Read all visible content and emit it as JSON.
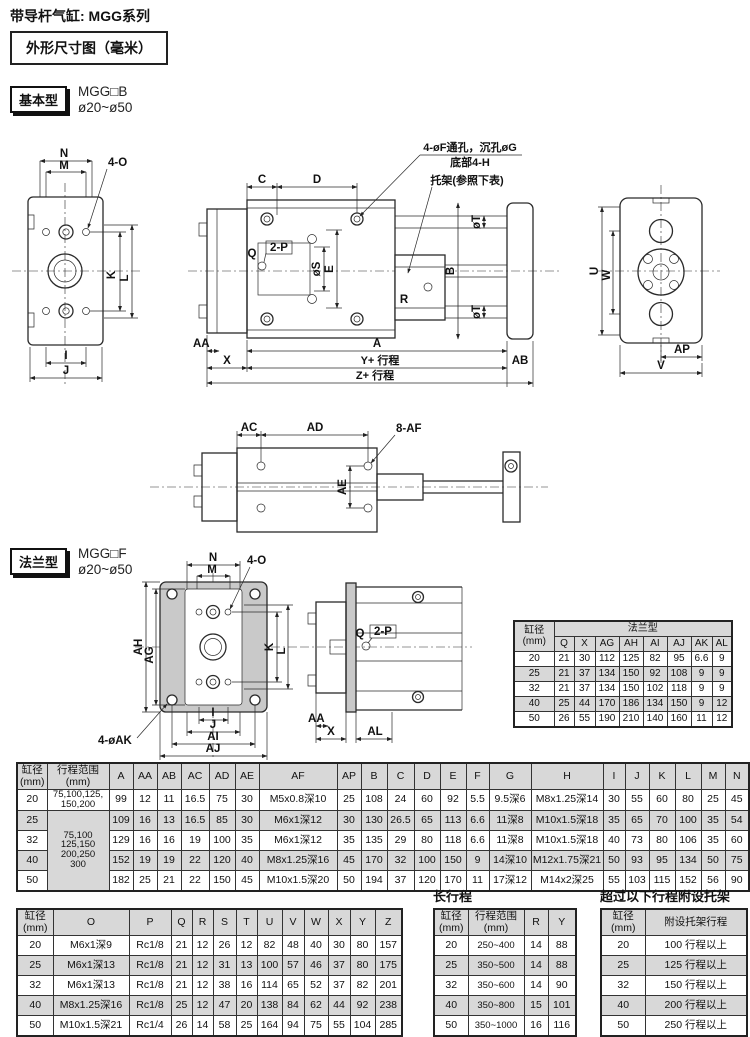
{
  "page": {
    "title": "带导杆气缸: MGG系列",
    "dimBoxTitle": "外形尺寸图（毫米）"
  },
  "colors": {
    "tableShade": "#d8d8d8",
    "flangePlate": "#c9c9c9",
    "line": "#2a2a2a"
  },
  "basic": {
    "badge": "基本型",
    "model": "MGG□B",
    "bore": "ø20~ø50"
  },
  "flange": {
    "badge": "法兰型",
    "model": "MGG□F",
    "bore": "ø20~ø50"
  },
  "labels": {
    "n": "N",
    "m": "M",
    "k": "K",
    "l": "L",
    "i": "I",
    "j": "J",
    "c": "C",
    "d": "D",
    "q": "Q",
    "e": "E",
    "b": "B",
    "r": "R",
    "a": "A",
    "x": "X",
    "u": "U",
    "w": "W",
    "v": "V",
    "aa": "AA",
    "ab": "AB",
    "ac": "AC",
    "ad": "AD",
    "ae": "AE",
    "ap": "AP",
    "ag": "AG",
    "ah": "AH",
    "ai": "AI",
    "aj": "AJ",
    "al": "AL",
    "fourO": "4-O",
    "twoP": "2-P",
    "phiS": "øS",
    "phiT": "øT",
    "eightAF": "8-AF",
    "fourAK": "4-øAK",
    "yStroke": "Y+ 行程",
    "zStroke": "Z+ 行程",
    "holeNote1": "4-øF通孔，沉孔øG",
    "holeNote2": "底部4-H",
    "bracketNote": "托架(参照下表)"
  },
  "flangeTable": {
    "boreHeader": "缸径\n(mm)",
    "groupHeader": "法兰型",
    "columns": [
      "Q",
      "X",
      "AG",
      "AH",
      "AI",
      "AJ",
      "AK",
      "AL"
    ],
    "rows": [
      [
        "20",
        "21",
        "30",
        "112",
        "125",
        "82",
        "95",
        "6.6",
        "9"
      ],
      [
        "25",
        "21",
        "37",
        "134",
        "150",
        "92",
        "108",
        "9",
        "9"
      ],
      [
        "32",
        "21",
        "37",
        "134",
        "150",
        "102",
        "118",
        "9",
        "9"
      ],
      [
        "40",
        "25",
        "44",
        "170",
        "186",
        "134",
        "150",
        "9",
        "12"
      ],
      [
        "50",
        "26",
        "55",
        "190",
        "210",
        "140",
        "160",
        "11",
        "12"
      ]
    ]
  },
  "mainTable": {
    "boreHeader": "缸径\n(mm)",
    "strokeHeader": "行程范围\n(mm)",
    "row20Stroke": "75,100,125,\n150,200",
    "mergedStroke": "75,100\n125,150\n200,250\n300",
    "columns": [
      "A",
      "AA",
      "AB",
      "AC",
      "AD",
      "AE",
      "AF",
      "AP",
      "B",
      "C",
      "D",
      "E",
      "F",
      "G",
      "H",
      "I",
      "J",
      "K",
      "L",
      "M",
      "N"
    ],
    "rows": [
      [
        "20",
        "99",
        "12",
        "11",
        "16.5",
        "75",
        "30",
        "M5x0.8深10",
        "25",
        "108",
        "24",
        "60",
        "92",
        "5.5",
        "9.5深6",
        "M8x1.25深14",
        "30",
        "55",
        "60",
        "80",
        "25",
        "45"
      ],
      [
        "25",
        "109",
        "16",
        "13",
        "16.5",
        "85",
        "30",
        "M6x1深12",
        "30",
        "130",
        "26.5",
        "65",
        "113",
        "6.6",
        "11深8",
        "M10x1.5深18",
        "35",
        "65",
        "70",
        "100",
        "35",
        "54"
      ],
      [
        "32",
        "129",
        "16",
        "16",
        "19",
        "100",
        "35",
        "M6x1深12",
        "35",
        "135",
        "29",
        "80",
        "118",
        "6.6",
        "11深8",
        "M10x1.5深18",
        "40",
        "73",
        "80",
        "106",
        "35",
        "60"
      ],
      [
        "40",
        "152",
        "19",
        "19",
        "22",
        "120",
        "40",
        "M8x1.25深16",
        "45",
        "170",
        "32",
        "100",
        "150",
        "9",
        "14深10",
        "M12x1.75深21",
        "50",
        "93",
        "95",
        "134",
        "50",
        "75"
      ],
      [
        "50",
        "182",
        "25",
        "21",
        "22",
        "150",
        "45",
        "M10x1.5深20",
        "50",
        "194",
        "37",
        "120",
        "170",
        "11",
        "17深12",
        "M14x2深25",
        "55",
        "103",
        "115",
        "152",
        "56",
        "90"
      ]
    ]
  },
  "lowerTable": {
    "boreHeader": "缸径\n(mm)",
    "columns": [
      "O",
      "P",
      "Q",
      "R",
      "S",
      "T",
      "U",
      "V",
      "W",
      "X",
      "Y",
      "Z"
    ],
    "rows": [
      [
        "20",
        "M6x1深9",
        "Rc1/8",
        "21",
        "12",
        "26",
        "12",
        "82",
        "48",
        "40",
        "30",
        "80",
        "157"
      ],
      [
        "25",
        "M6x1深13",
        "Rc1/8",
        "21",
        "12",
        "31",
        "13",
        "100",
        "57",
        "46",
        "37",
        "80",
        "175"
      ],
      [
        "32",
        "M6x1深13",
        "Rc1/8",
        "21",
        "12",
        "38",
        "16",
        "114",
        "65",
        "52",
        "37",
        "82",
        "201"
      ],
      [
        "40",
        "M8x1.25深16",
        "Rc1/8",
        "25",
        "12",
        "47",
        "20",
        "138",
        "84",
        "62",
        "44",
        "92",
        "238"
      ],
      [
        "50",
        "M10x1.5深21",
        "Rc1/4",
        "26",
        "14",
        "58",
        "25",
        "164",
        "94",
        "75",
        "55",
        "104",
        "285"
      ]
    ]
  },
  "longStrokeTable": {
    "title": "长行程",
    "boreHeader": "缸径\n(mm)",
    "strokeHeader": "行程范围\n(mm)",
    "columns": [
      "R",
      "Y"
    ],
    "rows": [
      [
        "20",
        "250~400",
        "14",
        "88"
      ],
      [
        "25",
        "350~500",
        "14",
        "88"
      ],
      [
        "32",
        "350~600",
        "14",
        "90"
      ],
      [
        "40",
        "350~800",
        "15",
        "101"
      ],
      [
        "50",
        "350~1000",
        "16",
        "116"
      ]
    ]
  },
  "bracketTable": {
    "title": "超过以下行程附设托架",
    "boreHeader": "缸径\n(mm)",
    "valueHeader": "附设托架行程",
    "rows": [
      [
        "20",
        "100 行程以上"
      ],
      [
        "25",
        "125 行程以上"
      ],
      [
        "32",
        "150 行程以上"
      ],
      [
        "40",
        "200 行程以上"
      ],
      [
        "50",
        "250 行程以上"
      ]
    ]
  }
}
